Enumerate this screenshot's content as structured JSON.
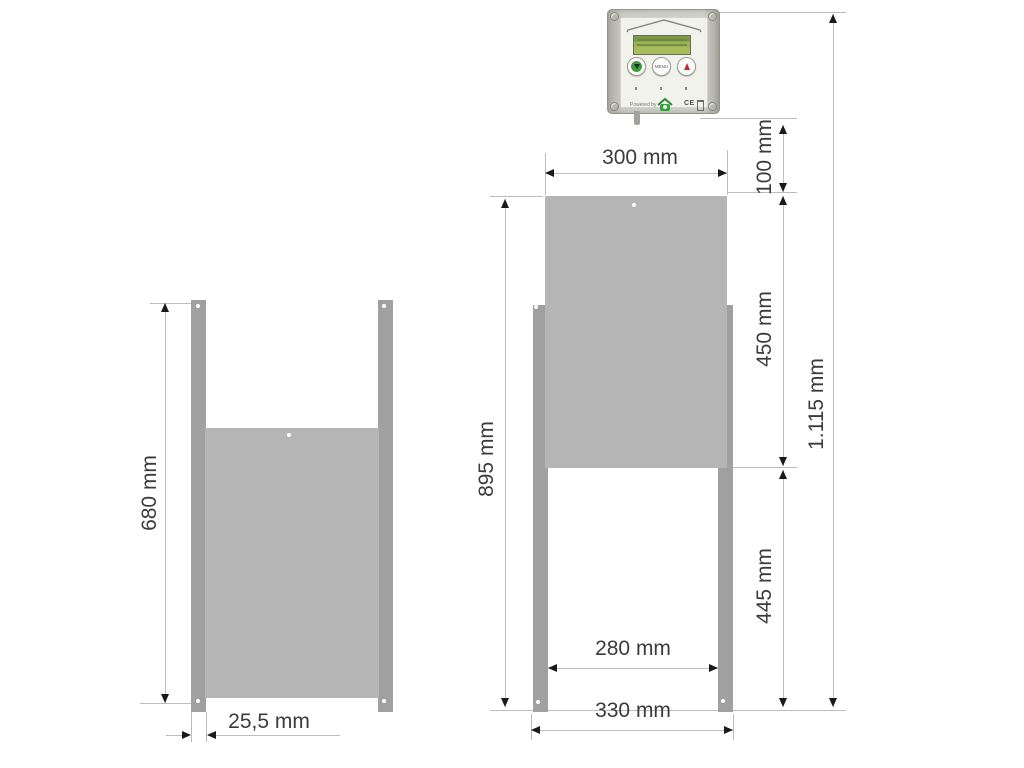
{
  "controller": {
    "menu_button_label": "MENU",
    "powered_by_label": "Powered by",
    "ce_label": "CE"
  },
  "dimensions": {
    "left_height": "680 mm",
    "left_rail_width": "25,5 mm",
    "right_top_width": "300 mm",
    "right_height": "895 mm",
    "right_gap": "100 mm",
    "right_upper": "450 mm",
    "right_lower": "445 mm",
    "right_total": "1.115 mm",
    "right_inner_width": "280 mm",
    "right_outer_width": "330 mm"
  },
  "colors": {
    "panel": "#b5b5b5",
    "rail": "#a0a0a0",
    "dim_line": "#bdbdbd",
    "arrow": "#1a1a1a",
    "dim_text": "#3b3b3b",
    "button_green": "#3c9c40",
    "button_red": "#c62828",
    "lcd_green": "#9db256"
  }
}
